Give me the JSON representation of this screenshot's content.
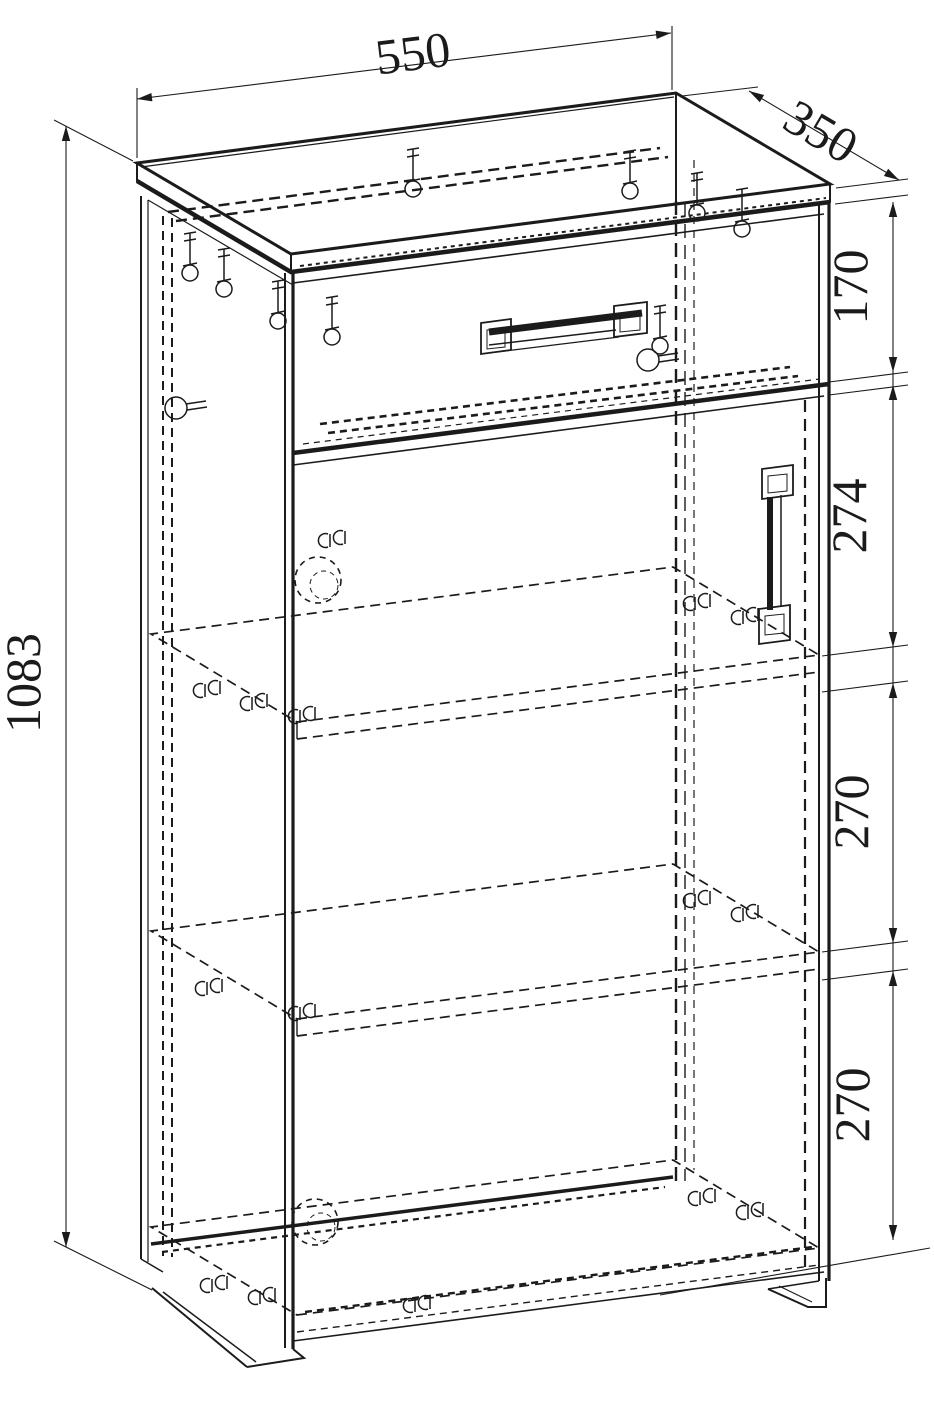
{
  "drawing": {
    "dimensions": {
      "width": "550",
      "depth": "350",
      "height": "1083",
      "drawer_front_height": "170",
      "section_top": "274",
      "section_middle": "270",
      "section_bottom": "270"
    },
    "colors": {
      "line": "#1b1b1b",
      "background": "#ffffff"
    }
  }
}
